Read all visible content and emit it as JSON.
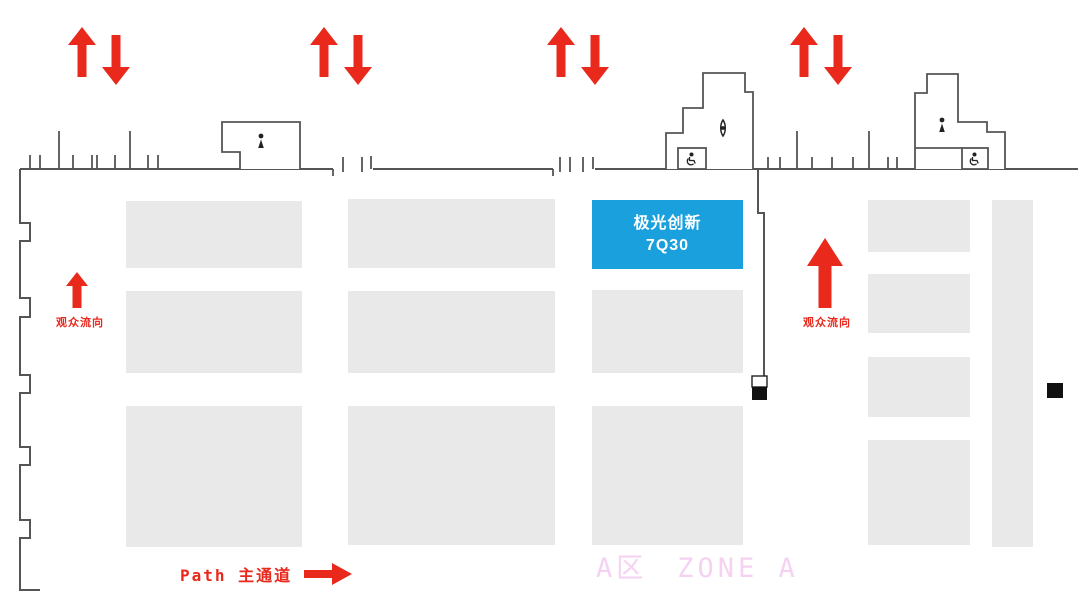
{
  "colors": {
    "accent_blue": "#1aa0dc",
    "red": "#e8291c",
    "booth_gray": "#e9e9e9",
    "wall": "#555555",
    "wall_dark": "#222222",
    "pink": "#f5d2f2"
  },
  "highlight_booth": {
    "name": "极光创新",
    "number": "7Q30",
    "x": 592,
    "y": 200,
    "w": 151,
    "h": 69
  },
  "labels": {
    "flow_direction": "观众流向",
    "path": "Path 主通道",
    "zone_cn": "A区",
    "zone_en": "ZONE A"
  },
  "floor": {
    "top_arrow_pairs": [
      {
        "x": 68,
        "y": 27
      },
      {
        "x": 310,
        "y": 27
      },
      {
        "x": 547,
        "y": 27
      },
      {
        "x": 790,
        "y": 27
      }
    ],
    "flow_arrows": [
      {
        "x": 66,
        "y": 272,
        "w": 22,
        "h": 36,
        "head": 14,
        "shaft": 9,
        "label_cx": 80,
        "label_y": 314
      },
      {
        "x": 807,
        "y": 238,
        "w": 36,
        "h": 70,
        "head": 28,
        "shaft": 13,
        "label_cx": 827,
        "label_y": 314
      }
    ],
    "booths": [
      {
        "x": 126,
        "y": 201,
        "w": 176,
        "h": 67
      },
      {
        "x": 126,
        "y": 291,
        "w": 176,
        "h": 82
      },
      {
        "x": 126,
        "y": 406,
        "w": 176,
        "h": 141
      },
      {
        "x": 348,
        "y": 199,
        "w": 207,
        "h": 69
      },
      {
        "x": 348,
        "y": 291,
        "w": 207,
        "h": 82
      },
      {
        "x": 348,
        "y": 406,
        "w": 207,
        "h": 139
      },
      {
        "x": 592,
        "y": 290,
        "w": 151,
        "h": 83
      },
      {
        "x": 592,
        "y": 406,
        "w": 151,
        "h": 139
      },
      {
        "x": 868,
        "y": 200,
        "w": 102,
        "h": 52
      },
      {
        "x": 868,
        "y": 274,
        "w": 102,
        "h": 59
      },
      {
        "x": 868,
        "y": 357,
        "w": 102,
        "h": 60
      },
      {
        "x": 868,
        "y": 440,
        "w": 102,
        "h": 105
      },
      {
        "x": 992,
        "y": 200,
        "w": 41,
        "h": 347
      }
    ],
    "black_squares": [
      {
        "x": 752,
        "y": 387,
        "w": 15,
        "h": 13
      },
      {
        "x": 1047,
        "y": 383,
        "w": 16,
        "h": 15
      }
    ],
    "icons": [
      {
        "name": "person-icon",
        "x": 261,
        "y": 142
      },
      {
        "name": "valve-icon",
        "x": 723,
        "y": 128
      },
      {
        "name": "wheelchair-icon",
        "x": 691,
        "y": 159
      },
      {
        "name": "person-icon",
        "x": 942,
        "y": 126
      },
      {
        "name": "wheelchair-icon",
        "x": 974,
        "y": 159
      }
    ]
  }
}
